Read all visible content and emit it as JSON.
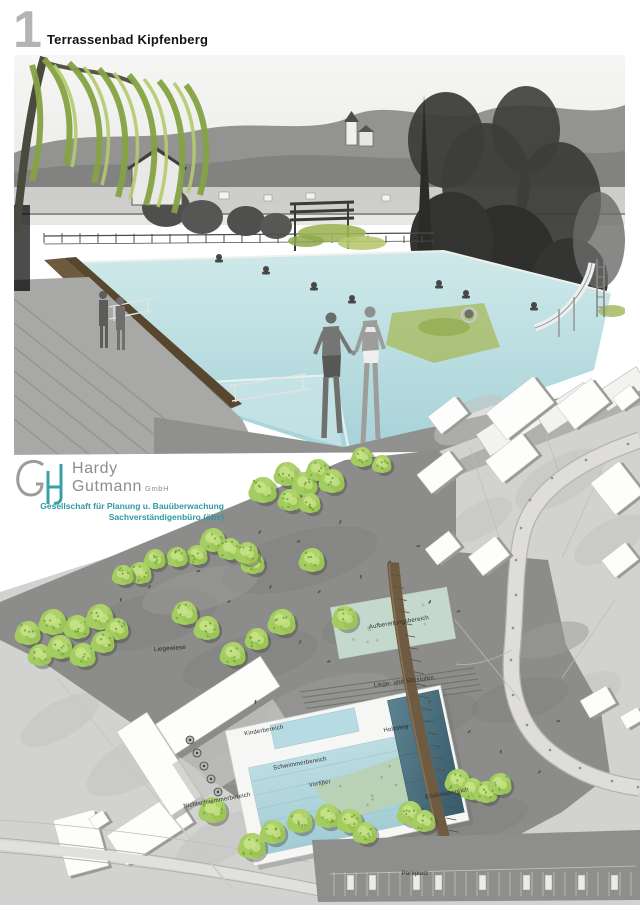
{
  "page": {
    "number": "1",
    "title": "Terrassenbad Kipfenberg"
  },
  "logo": {
    "monogram": "GH",
    "name_first": "Hardy",
    "name_last": "Gutmann",
    "name_suffix": "GmbH",
    "tagline_line1": "Gesellschaft für Planung u. Bauüberwachung",
    "tagline_line2": "Sachverständigenbüro (öbv)"
  },
  "plan": {
    "labels": {
      "liegewiese": "Liegewiese",
      "aufbereitungsbereich": "Aufbereitungsbereich",
      "liege_und_sitzstufen": "Liege- und Sitzstufen",
      "kinderbereich": "Kinderbereich",
      "holzsteg": "Holzsteg",
      "schwimmerbereich": "Schwimmerbereich",
      "vorfilter": "Vorfilter",
      "nichtschwimmerbereich": "Nichtschwimmerbereich",
      "erlebnisbereich": "Erlebnisbereich",
      "parkplatz": "Parkplatz"
    }
  },
  "colors": {
    "accent_teal": "#2d9aa1",
    "title_number_gray": "#b4b4b4",
    "pool_water_light": "#b7dbe2",
    "pool_water_deep": "#44707f",
    "tree_green": "#a3cd60",
    "wood_brown": "#6f5b42",
    "site_gray": "#8c8c8a",
    "context_gray": "#d2d2d0"
  }
}
